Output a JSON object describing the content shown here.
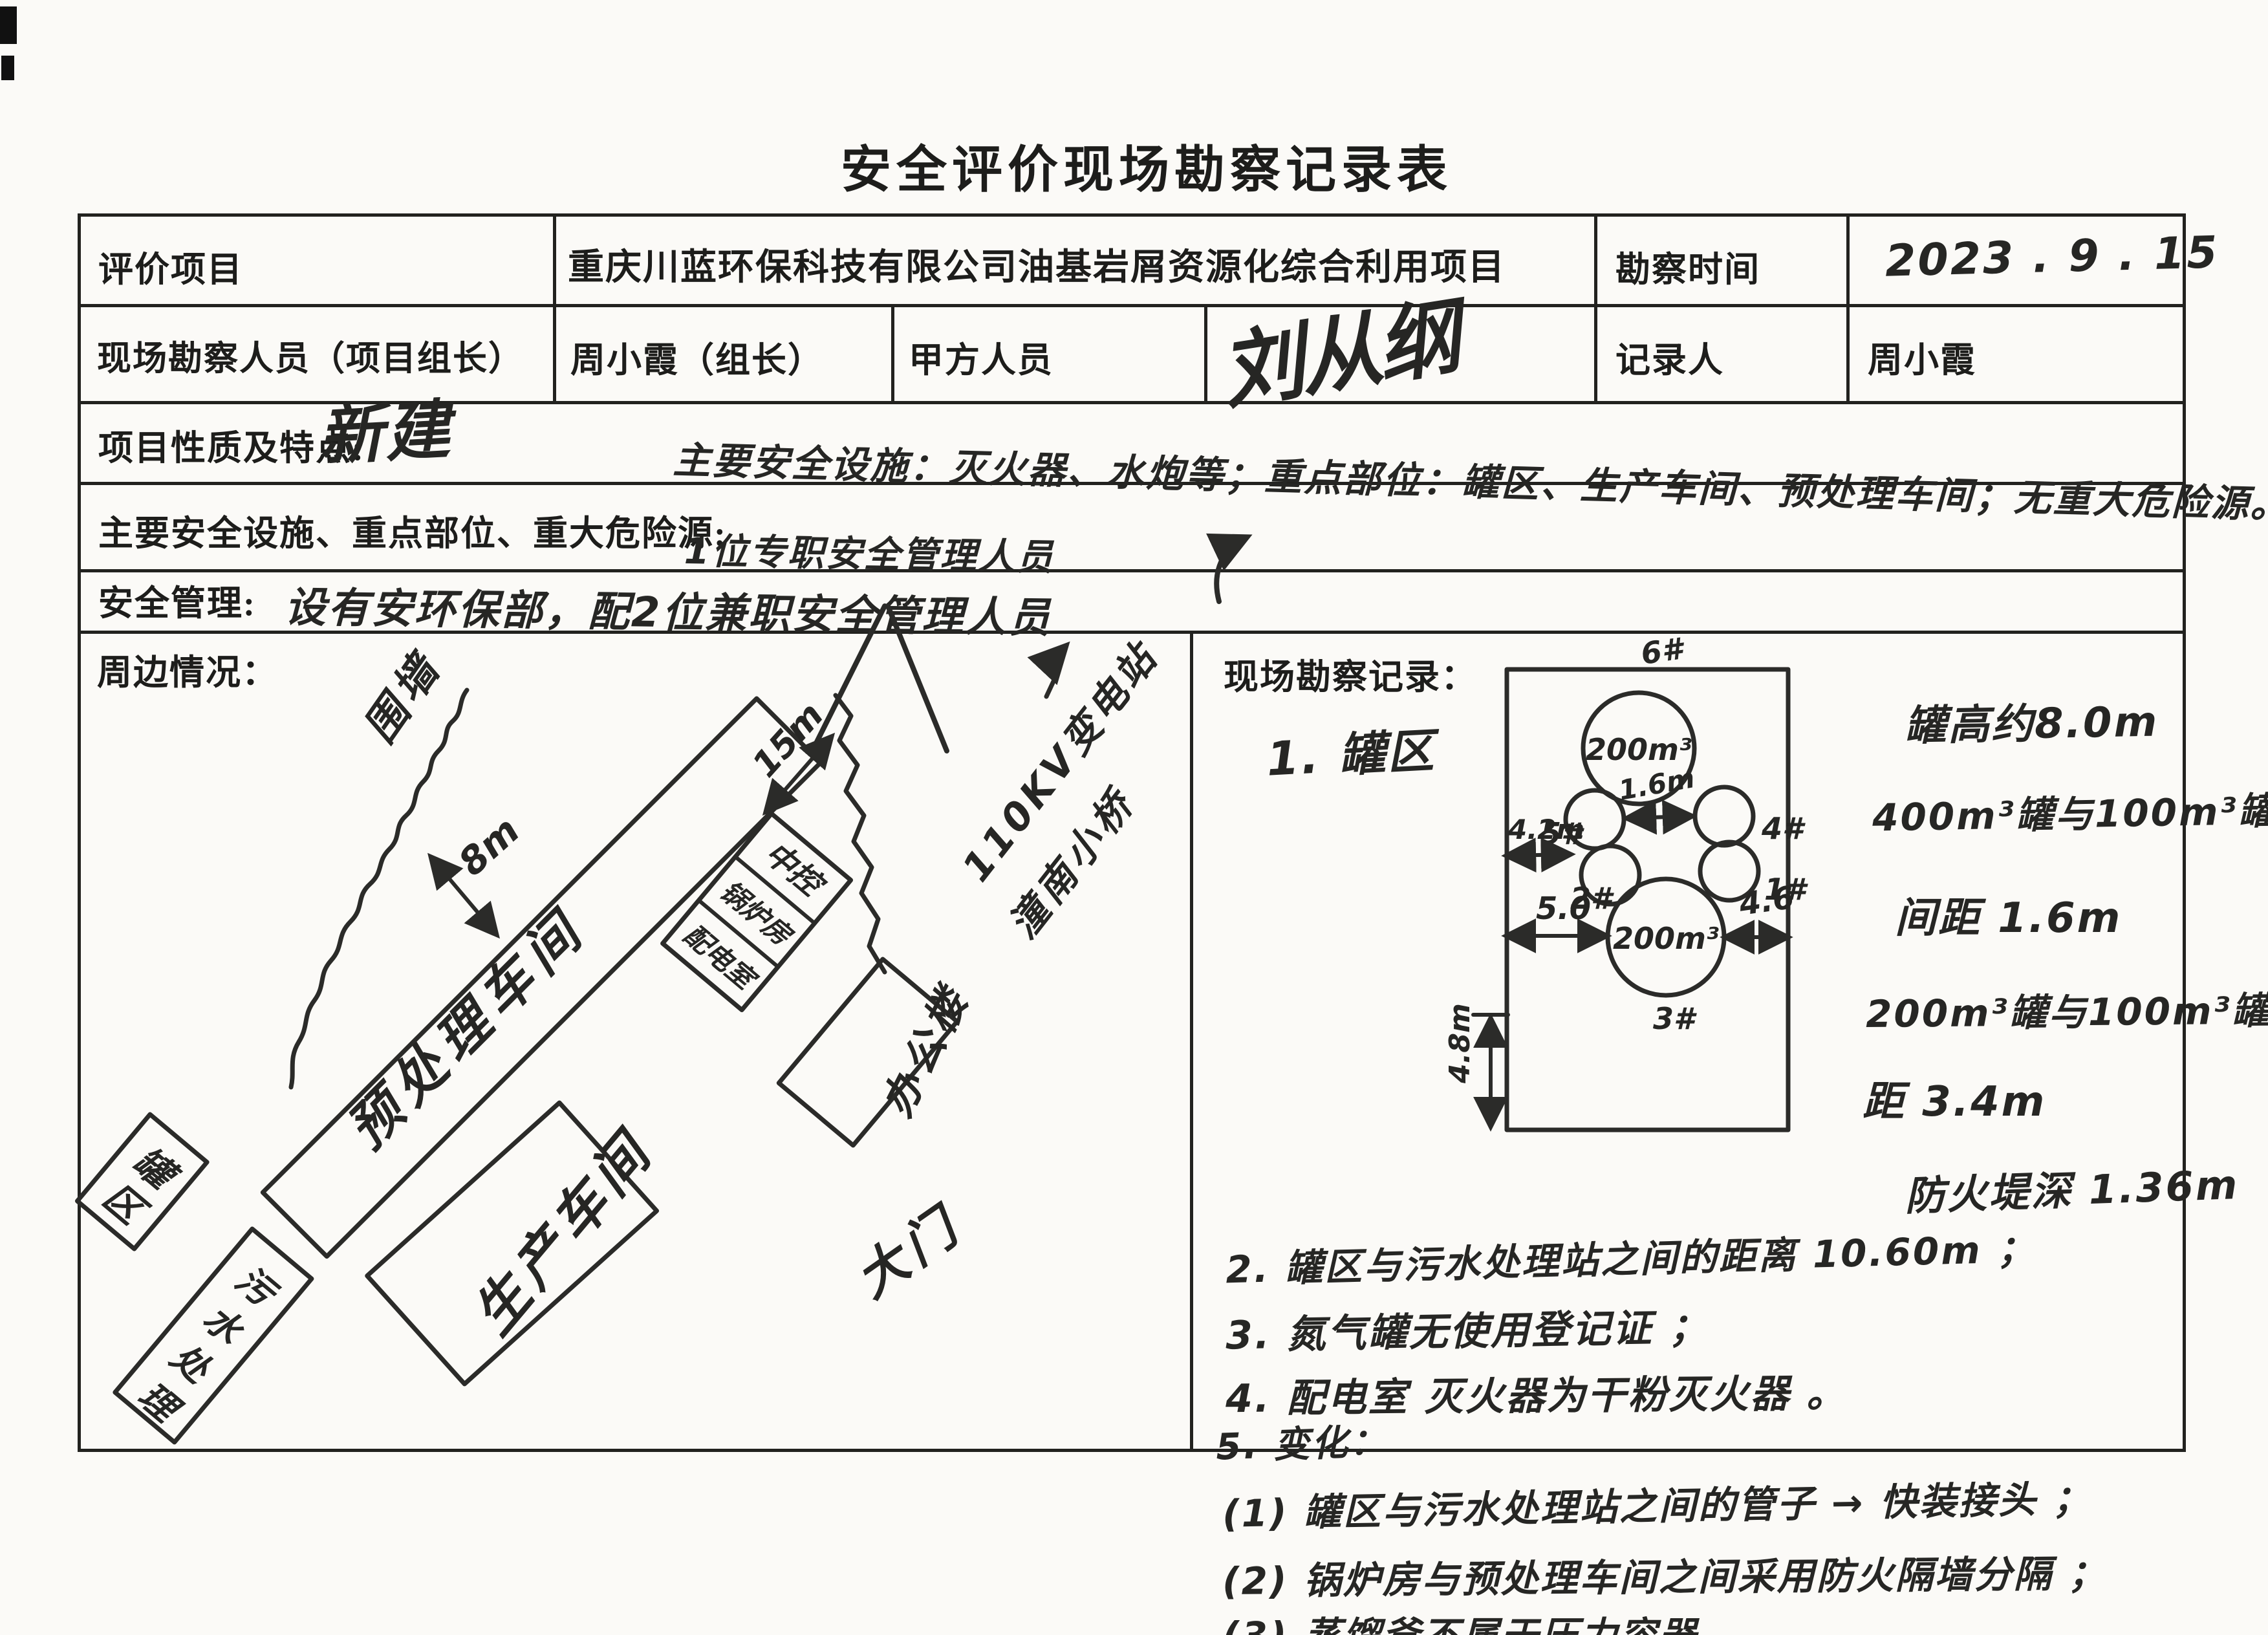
{
  "colors": {
    "paper": "#fbfaf7",
    "ink": "#1d1d1b",
    "pen": "#262624"
  },
  "title": "安全评价现场勘察记录表",
  "header": {
    "eval_project_label": "评价项目",
    "eval_project_value": "重庆川蓝环保科技有限公司油基岩屑资源化综合利用项目",
    "survey_time_label": "勘察时间",
    "survey_time_value": "2023 . 9 . 15",
    "surveyor_label": "现场勘察人员（项目组长）",
    "surveyor_value": "周小霞（组长）",
    "party_a_label": "甲方人员",
    "party_a_signature": "刘从纲",
    "recorder_label": "记录人",
    "recorder_value": "周小霞",
    "nature_label": "项目性质及特点:",
    "nature_value": "新建",
    "safety_label": "主要安全设施、重点部位、重大危险源:",
    "safety_value": "主要安全设施：灭火器、水炮等；重点部位：罐区、生产车间、预处理车间；无重大危险源。",
    "management_label": "安全管理:",
    "management_value": "设有安环保部，配2位兼职安全管理人员",
    "management_insert": "1位专职安全管理人员"
  },
  "site_plan": {
    "section_label": "周边情况：",
    "fence": "围墙",
    "dim_8m": "8m",
    "dim_15m": "15m",
    "substation_line1": "110KV变电站",
    "substation_line2": "潼南小桥",
    "pretreatment": "预处理车间",
    "control_room": "中控",
    "boiler_room": "锅炉房",
    "power_room": "配电室",
    "office": "办公楼",
    "gate": "大门",
    "production": "生产车间",
    "tank_area_char1": "罐",
    "tank_area_char2": "区",
    "sewage_char1": "污",
    "sewage_char2": "水",
    "sewage_char3": "处",
    "sewage_char4": "理"
  },
  "survey": {
    "section_label": "现场勘察记录：",
    "item1": "1. 罐区",
    "note_height": "罐高约8.0m",
    "note_gap1a": "400m³罐与100m³罐",
    "note_gap1b": "间距 1.6m",
    "note_gap2a": "200m³罐与100m³罐间",
    "note_gap2b": "距 3.4m",
    "note_dike": "防火堤深 1.36m",
    "item2": "2. 罐区与污水处理站之间的距离 10.60m ；",
    "item3": "3. 氮气罐无使用登记证 ；",
    "item4": "4. 配电室 灭火器为干粉灭火器 。",
    "item5": "5. 变化：",
    "sub1": "(1) 罐区与污水处理站之间的管子 → 快装接头 ；",
    "sub2": "(2) 锅炉房与预处理车间之间采用防火隔墙分隔 ；",
    "sub3": "(3) 蒸馏釜不属于压力容器 。"
  },
  "tank_diagram": {
    "tank6_label": "200m³",
    "tank6_id": "6#",
    "tank5_id": "5#",
    "tank4_id": "4#",
    "tank2_id": "2#",
    "tank1_id": "1#",
    "tank3_label": "200m³",
    "tank3_id": "3#",
    "dim_16": "1.6m",
    "dim_42": "4.2m",
    "dim_50": "5.0",
    "dim_46": "4.6",
    "dim_48": "4.8m"
  }
}
